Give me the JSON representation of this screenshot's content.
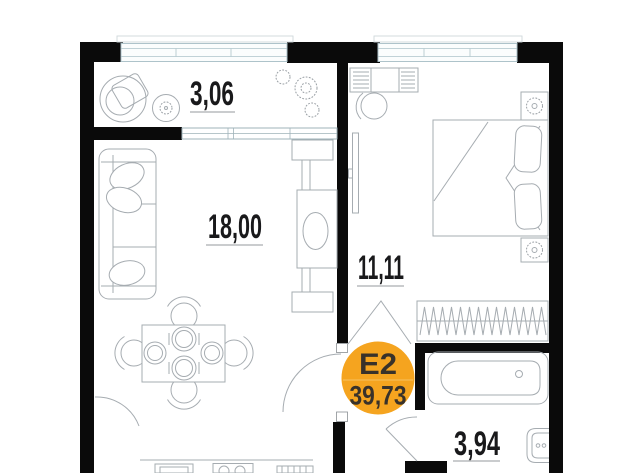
{
  "floorplan": {
    "rooms": [
      {
        "id": "balcony",
        "area": "3,06"
      },
      {
        "id": "living-room",
        "area": "18,00"
      },
      {
        "id": "bedroom",
        "area": "11,11"
      },
      {
        "id": "bathroom",
        "area": "3,94"
      }
    ],
    "badge": {
      "unit": "Е2",
      "total_area": "39,73",
      "fill": "#F5A41F",
      "divider": "#F8BC55",
      "text_color": "#39322A"
    },
    "colors": {
      "wall": "#0A0A0A",
      "furniture_line": "#A6ACB1",
      "window_frame": "#AEC3CA",
      "label_text": "#19191B",
      "underline": "#ABAEB1",
      "background": "#FFFFFF"
    }
  }
}
